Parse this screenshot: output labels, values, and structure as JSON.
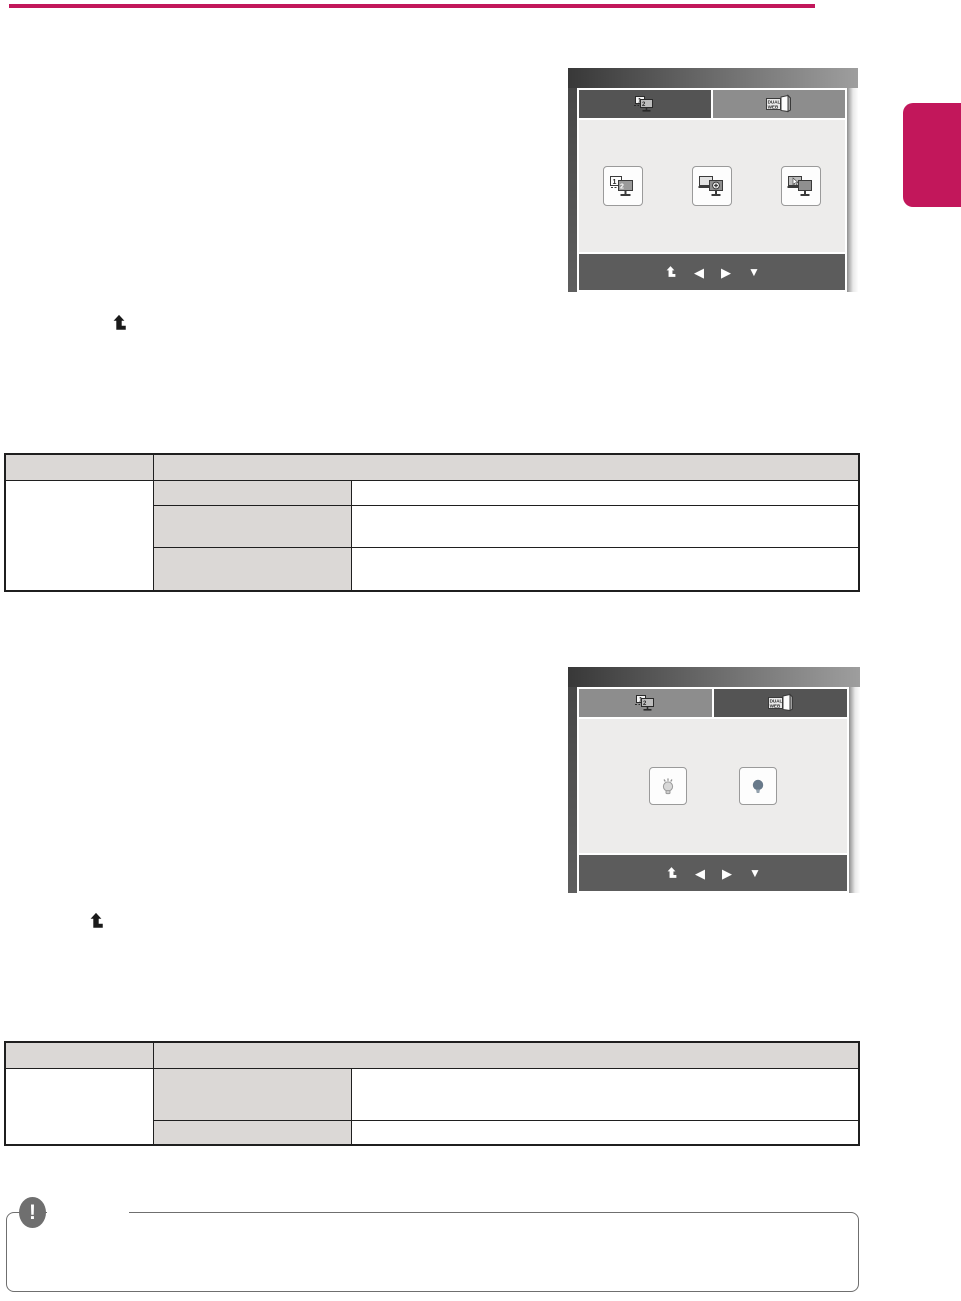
{
  "page": {
    "width": 961,
    "height": 1301,
    "background": "#ffffff",
    "accent": "#c2175b"
  },
  "top_rule": {
    "color": "#c2175b"
  },
  "side_tab": {
    "color": "#c2175b"
  },
  "osd1": {
    "colors": {
      "tab_active": "#545454",
      "tab_inactive": "#8d8d8d",
      "screen_bg": "#edeceb",
      "navbar": "#5c5c5c"
    },
    "tab_display": {
      "icon": "dual-monitor-icon",
      "monitor1_label": "1",
      "monitor2_label": "2",
      "active": true
    },
    "tab_dualweb": {
      "icon": "dual-web-icon",
      "line1": "DUAL",
      "line2": "WEB",
      "active": false
    },
    "buttons": [
      {
        "icon": "dual-monitor-12-icon",
        "monitor1_label": "1",
        "monitor2_label": "2"
      },
      {
        "icon": "monitor-settings-icon"
      },
      {
        "icon": "monitor-pointer-icon"
      }
    ],
    "nav": {
      "exit_icon": "exit-up-arrow-icon",
      "left_glyph": "◀",
      "right_glyph": "▶",
      "down_glyph": "▼"
    }
  },
  "osd2": {
    "colors": {
      "tab_active": "#545454",
      "tab_inactive": "#8d8d8d",
      "screen_bg": "#edeceb",
      "navbar": "#5c5c5c"
    },
    "tab_display": {
      "icon": "dual-monitor-icon",
      "monitor1_label": "1",
      "monitor2_label": "2",
      "active": false
    },
    "tab_dualweb": {
      "icon": "dual-web-icon",
      "line1": "DUAL",
      "line2": "WEB",
      "active": true
    },
    "buttons": [
      {
        "icon": "bulb-on-icon",
        "color": "#d8d8d8"
      },
      {
        "icon": "bulb-off-icon",
        "color": "#68798a"
      }
    ],
    "nav": {
      "exit_icon": "exit-up-arrow-icon",
      "left_glyph": "◀",
      "right_glyph": "▶",
      "down_glyph": "▼"
    }
  },
  "inline_icons": [
    {
      "icon": "exit-up-arrow-icon",
      "color": "#1a1a1a"
    },
    {
      "icon": "exit-up-arrow-icon",
      "color": "#1a1a1a"
    }
  ],
  "table1": {
    "header_bg": "#dbd8d6",
    "border_color": "#1f1f1f",
    "header": [
      "",
      ""
    ],
    "rows": [
      {
        "item": "",
        "desc": ""
      },
      {
        "item": "",
        "desc": ""
      },
      {
        "item": "",
        "desc": ""
      }
    ]
  },
  "table2": {
    "header_bg": "#dbd8d6",
    "border_color": "#1f1f1f",
    "header": [
      "",
      ""
    ],
    "rows": [
      {
        "item": "",
        "desc": ""
      },
      {
        "item": "",
        "desc": ""
      }
    ]
  },
  "note_box": {
    "icon": "exclamation-icon",
    "glyph": "!",
    "border_color": "#6f6f6f",
    "icon_color": "#6f6f6f"
  }
}
